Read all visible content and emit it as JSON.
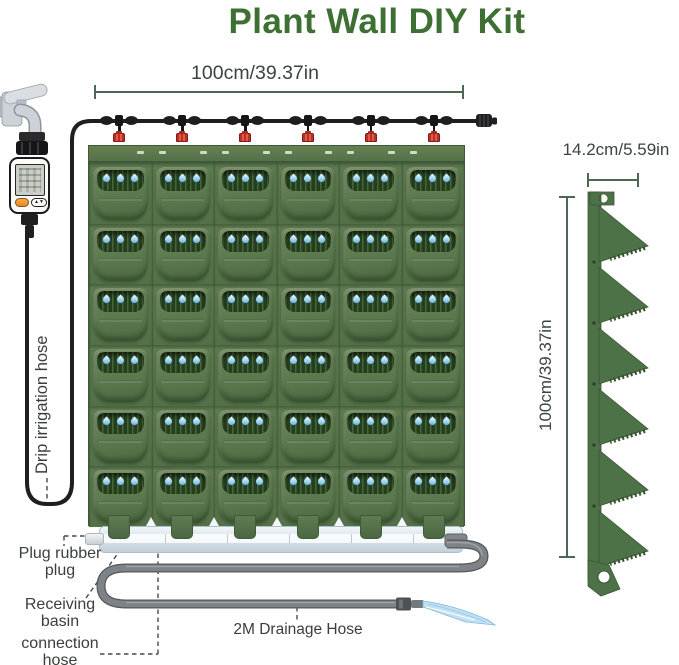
{
  "title": "Plant Wall DIY Kit",
  "dimensions": {
    "wall_width": "100cm/39.37in",
    "panel_width": "14.2cm/5.59in",
    "panel_height": "100cm/39.37in"
  },
  "labels": {
    "drip_irrigation_hose": "Drip irrigation hose",
    "plug_line1": "Plug rubber",
    "plug_line2": "plug",
    "basin_line1": "Receiving",
    "basin_line2": "basin",
    "connection_line1": "connection",
    "connection_line2": "hose",
    "drainage_hose": "2M Drainage Hose"
  },
  "wall": {
    "rows": 6,
    "cols": 6,
    "pockets": 36,
    "drops_per_pocket": 3,
    "emitter_count": 6
  },
  "timer": {
    "arrow_up": "▲",
    "arrow_down": "▼"
  },
  "colors": {
    "title_green": "#3E7034",
    "dim_line_green": "#4D6752",
    "label_text": "#3A3F3B",
    "planter_green": "#58744B",
    "pocket_interior": "#263E20",
    "water_drop_blue": "#6FB9E2",
    "dripper_red": "#CE3A2E",
    "drip_hose_black": "#1F1F21",
    "drainage_hose_gray": "#7E8387",
    "basin_blue": "#DFE9EF",
    "profile_green": "#4E7247"
  }
}
